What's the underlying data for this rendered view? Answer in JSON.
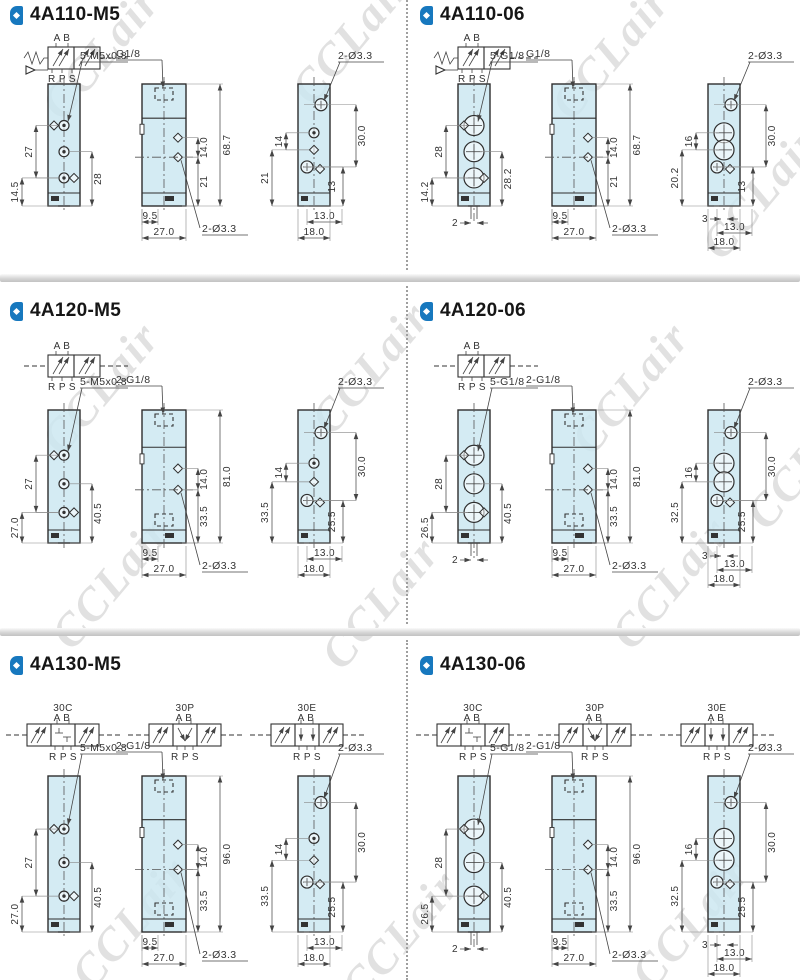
{
  "watermark": {
    "text": "CCLair"
  },
  "colors": {
    "accent": "#1778be",
    "body_fill": "#cbe7f0",
    "line": "#2e2e2e",
    "watermark": "#dadada"
  },
  "sections": [
    {
      "title": "4A110-M5",
      "symbols": [
        {
          "type": "2pos-spring",
          "name": "",
          "top": "A B",
          "bottom": "R P S"
        }
      ],
      "views": [
        {
          "kind": "front",
          "ports": "M5",
          "thread_label": "5-M5x0.8",
          "dims_left": [
            "27",
            "14.5"
          ],
          "dims_right": [
            "28"
          ],
          "dims_bottom": []
        },
        {
          "kind": "side",
          "top_label": "G1/8",
          "hole_label": "2-Ø3.3",
          "bottom_port": false,
          "dims_right": [
            "14.0",
            "68.7",
            "21"
          ],
          "dims_bottom": [
            "9.5",
            "27.0"
          ]
        },
        {
          "kind": "end",
          "ports": "M5",
          "hole_label": "2-Ø3.3",
          "dims_left": [
            "14",
            "21"
          ],
          "dims_right": [
            "30.0",
            "13"
          ],
          "dims_bottom": [
            "13.0",
            "18.0"
          ]
        }
      ]
    },
    {
      "title": "4A110-06",
      "symbols": [
        {
          "type": "2pos-spring",
          "name": "",
          "top": "A B",
          "bottom": "R P S"
        }
      ],
      "views": [
        {
          "kind": "front",
          "ports": "G1/8",
          "thread_label": "5-G1/8",
          "dims_left": [
            "28",
            "14.2"
          ],
          "dims_right": [
            "28.2"
          ],
          "dims_bottom": [
            "2"
          ]
        },
        {
          "kind": "side",
          "top_label": "G1/8",
          "hole_label": "2-Ø3.3",
          "bottom_port": false,
          "dims_right": [
            "14.0",
            "68.7",
            "21"
          ],
          "dims_bottom": [
            "9.5",
            "27.0"
          ]
        },
        {
          "kind": "end",
          "ports": "G1/8",
          "hole_label": "2-Ø3.3",
          "dims_left": [
            "16",
            "20.2"
          ],
          "dims_right": [
            "30.0",
            "13"
          ],
          "dims_bottom": [
            "3",
            "13.0",
            "18.0"
          ]
        }
      ]
    },
    {
      "title": "4A120-M5",
      "symbols": [
        {
          "type": "2pos-double",
          "name": "",
          "top": "A B",
          "bottom": "R P S"
        }
      ],
      "views": [
        {
          "kind": "front",
          "ports": "M5",
          "thread_label": "5-M5x0.8",
          "dims_left": [
            "27",
            "27.0"
          ],
          "dims_right": [
            "40.5"
          ],
          "dims_bottom": []
        },
        {
          "kind": "side",
          "top_label": "2-G1/8",
          "hole_label": "2-Ø3.3",
          "bottom_port": true,
          "dims_right": [
            "14.0",
            "81.0",
            "33.5"
          ],
          "dims_bottom": [
            "9.5",
            "27.0"
          ]
        },
        {
          "kind": "end",
          "ports": "M5",
          "hole_label": "2-Ø3.3",
          "dims_left": [
            "14",
            "33.5"
          ],
          "dims_right": [
            "30.0",
            "25.5"
          ],
          "dims_bottom": [
            "13.0",
            "18.0"
          ]
        }
      ]
    },
    {
      "title": "4A120-06",
      "symbols": [
        {
          "type": "2pos-double",
          "name": "",
          "top": "A B",
          "bottom": "R P S"
        }
      ],
      "views": [
        {
          "kind": "front",
          "ports": "G1/8",
          "thread_label": "5-G1/8",
          "dims_left": [
            "28",
            "26.5"
          ],
          "dims_right": [
            "40.5"
          ],
          "dims_bottom": [
            "2"
          ]
        },
        {
          "kind": "side",
          "top_label": "2-G1/8",
          "hole_label": "2-Ø3.3",
          "bottom_port": true,
          "dims_right": [
            "14.0",
            "81.0",
            "33.5"
          ],
          "dims_bottom": [
            "9.5",
            "27.0"
          ]
        },
        {
          "kind": "end",
          "ports": "G1/8",
          "hole_label": "2-Ø3.3",
          "dims_left": [
            "16",
            "32.5"
          ],
          "dims_right": [
            "30.0",
            "25.5"
          ],
          "dims_bottom": [
            "3",
            "13.0",
            "18.0"
          ]
        }
      ]
    },
    {
      "title": "4A130-M5",
      "symbols": [
        {
          "type": "3pos",
          "name": "30C",
          "top": "A B",
          "bottom": "R P S"
        },
        {
          "type": "3pos",
          "name": "30P",
          "top": "A B",
          "bottom": "R P S"
        },
        {
          "type": "3pos",
          "name": "30E",
          "top": "A B",
          "bottom": "R P S"
        }
      ],
      "views": [
        {
          "kind": "front",
          "ports": "M5",
          "thread_label": "5-M5x0.8",
          "dims_left": [
            "27",
            "27.0"
          ],
          "dims_right": [
            "40.5"
          ],
          "dims_bottom": []
        },
        {
          "kind": "side",
          "top_label": "2-G1/8",
          "hole_label": "2-Ø3.3",
          "bottom_port": true,
          "dims_right": [
            "14.0",
            "96.0",
            "33.5"
          ],
          "dims_bottom": [
            "9.5",
            "27.0"
          ]
        },
        {
          "kind": "end",
          "ports": "M5",
          "hole_label": "2-Ø3.3",
          "dims_left": [
            "14",
            "33.5"
          ],
          "dims_right": [
            "30.0",
            "25.5"
          ],
          "dims_bottom": [
            "13.0",
            "18.0"
          ]
        }
      ]
    },
    {
      "title": "4A130-06",
      "symbols": [
        {
          "type": "3pos",
          "name": "30C",
          "top": "A B",
          "bottom": "R P S"
        },
        {
          "type": "3pos",
          "name": "30P",
          "top": "A B",
          "bottom": "R P S"
        },
        {
          "type": "3pos",
          "name": "30E",
          "top": "A B",
          "bottom": "R P S"
        }
      ],
      "views": [
        {
          "kind": "front",
          "ports": "G1/8",
          "thread_label": "5-G1/8",
          "dims_left": [
            "28",
            "26.5"
          ],
          "dims_right": [
            "40.5"
          ],
          "dims_bottom": [
            "2"
          ]
        },
        {
          "kind": "side",
          "top_label": "2-G1/8",
          "hole_label": "2-Ø3.3",
          "bottom_port": true,
          "dims_right": [
            "14.0",
            "96.0",
            "33.5"
          ],
          "dims_bottom": [
            "9.5",
            "27.0"
          ]
        },
        {
          "kind": "end",
          "ports": "G1/8",
          "hole_label": "2-Ø3.3",
          "dims_left": [
            "16",
            "32.5"
          ],
          "dims_right": [
            "30.0",
            "25.5"
          ],
          "dims_bottom": [
            "3",
            "13.0",
            "18.0"
          ]
        }
      ]
    }
  ]
}
